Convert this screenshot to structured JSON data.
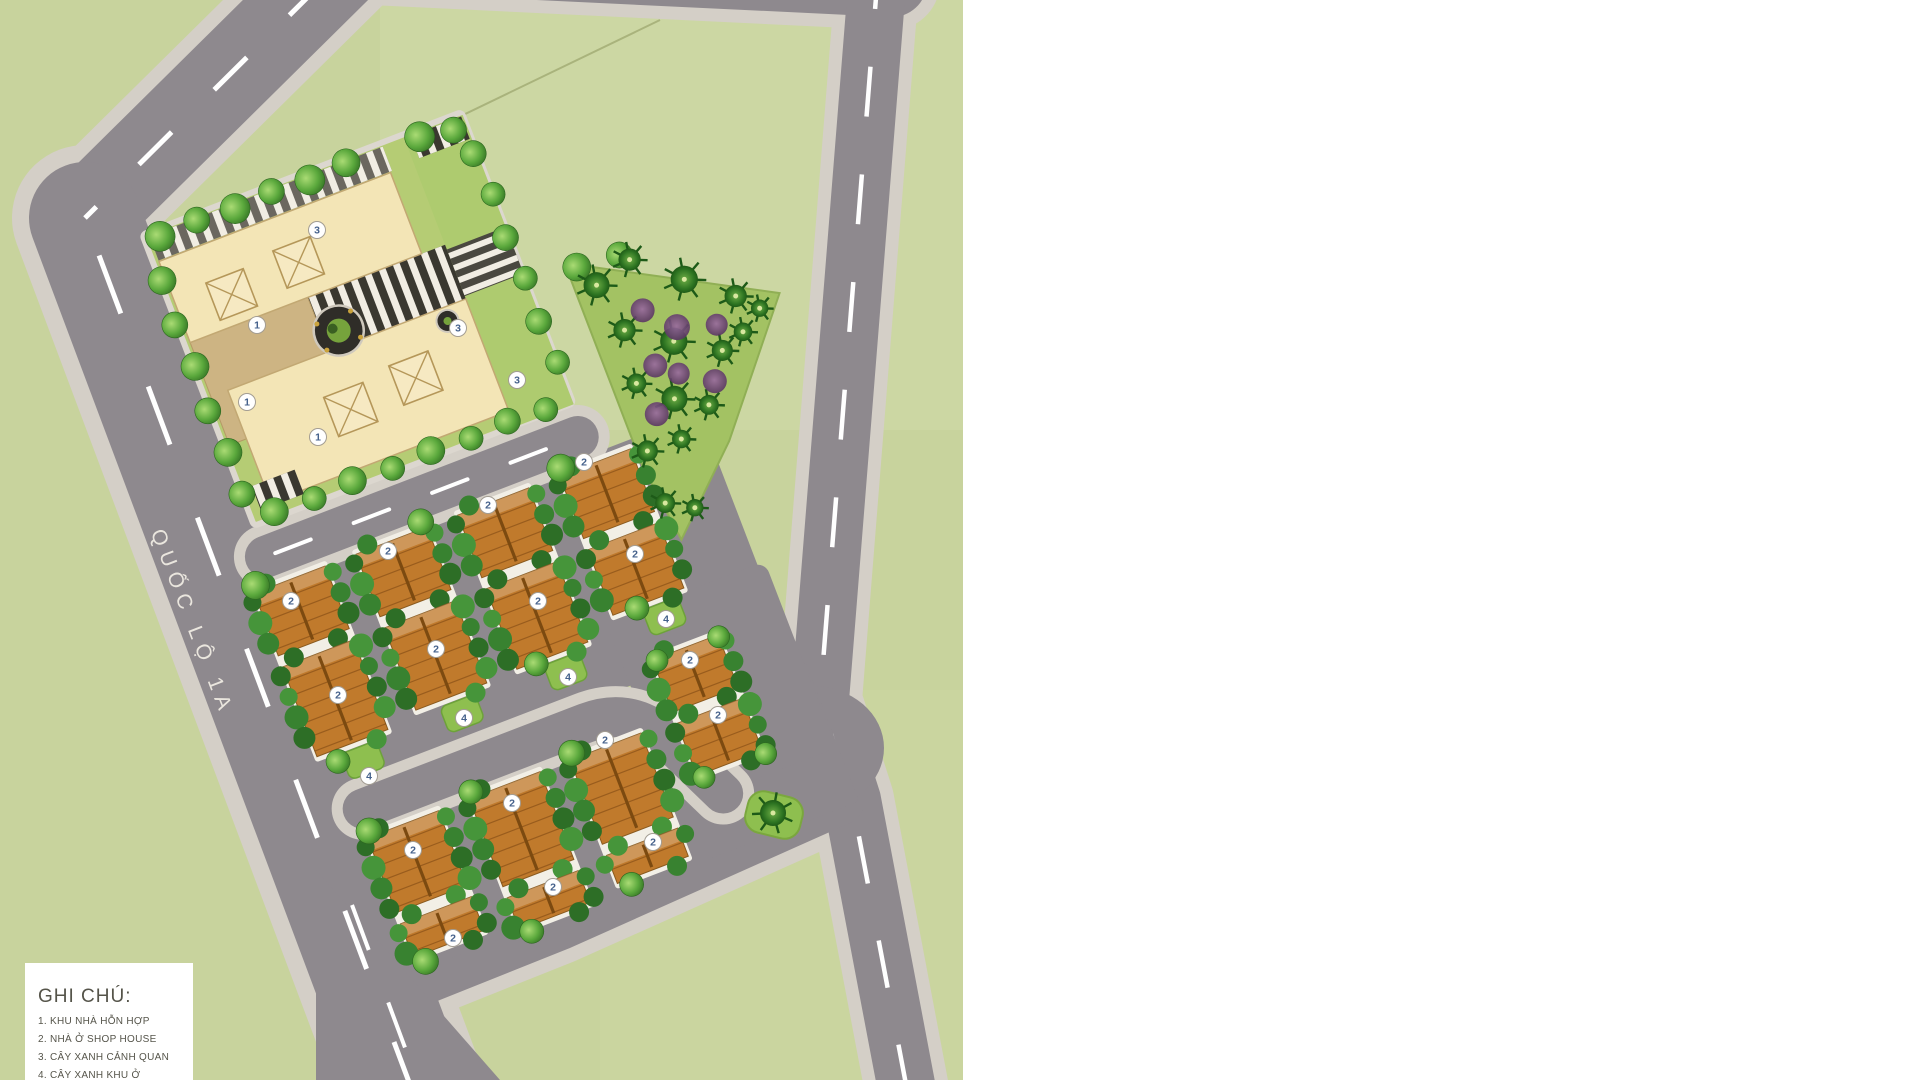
{
  "page": {
    "background": "#ffffff",
    "plan_width": 963,
    "plan_height": 1080
  },
  "road_label": {
    "text": "QUỐC LỘ 1A",
    "x": 186,
    "y": 625,
    "angle": 69
  },
  "legend": {
    "title": "GHI CHÚ:",
    "items": [
      "1. KHU NHÀ HỖN HỢP",
      "2. NHÀ Ở SHOP HOUSE",
      "3. CÂY XANH CẢNH QUAN",
      "4. CÂY XANH KHU Ở"
    ],
    "x": 25,
    "y": 963,
    "width": 168,
    "height": 130
  },
  "colors": {
    "field": "#c8d39d",
    "field_alt": "#cfdaa8",
    "parcel_line": "#a9b37c",
    "asphalt": "#8e898e",
    "sidewalk": "#d4cfc7",
    "dash": "#ffffff",
    "cream": "#f3e5b6",
    "cream_border": "#c2a873",
    "tan": "#cdb483",
    "plaza": "#3a3830",
    "walk_stripe": "#f1ede3",
    "roof": "#c07a2c",
    "roof_ridge": "#7c4a10",
    "roof_line": "#9c621f",
    "row_base": "#f2efe6",
    "bush": [
      "#2d6e26",
      "#46953a",
      "#388230"
    ],
    "park_ground": "#a3c263",
    "strip_green": "#8ebf4f",
    "marker_bg": "#ffffff",
    "marker_ring": "#a39d93",
    "marker_text": "#46628c",
    "label_color": "#eae6de",
    "legend_text": "#55544a"
  },
  "map": {
    "rotation": -21,
    "pivot": [
      420,
      640
    ],
    "markers": [
      {
        "n": "1",
        "x": 257,
        "y": 325
      },
      {
        "n": "1",
        "x": 247,
        "y": 402
      },
      {
        "n": "1",
        "x": 318,
        "y": 437
      },
      {
        "n": "2",
        "x": 291,
        "y": 601
      },
      {
        "n": "2",
        "x": 338,
        "y": 695
      },
      {
        "n": "2",
        "x": 388,
        "y": 551
      },
      {
        "n": "2",
        "x": 436,
        "y": 649
      },
      {
        "n": "2",
        "x": 488,
        "y": 505
      },
      {
        "n": "2",
        "x": 538,
        "y": 601
      },
      {
        "n": "2",
        "x": 584,
        "y": 462
      },
      {
        "n": "2",
        "x": 635,
        "y": 554
      },
      {
        "n": "2",
        "x": 690,
        "y": 660
      },
      {
        "n": "2",
        "x": 718,
        "y": 715
      },
      {
        "n": "2",
        "x": 413,
        "y": 850
      },
      {
        "n": "2",
        "x": 453,
        "y": 938
      },
      {
        "n": "2",
        "x": 512,
        "y": 803
      },
      {
        "n": "2",
        "x": 553,
        "y": 887
      },
      {
        "n": "2",
        "x": 605,
        "y": 740
      },
      {
        "n": "2",
        "x": 653,
        "y": 842
      },
      {
        "n": "3",
        "x": 317,
        "y": 230
      },
      {
        "n": "3",
        "x": 458,
        "y": 328
      },
      {
        "n": "3",
        "x": 517,
        "y": 380
      },
      {
        "n": "4",
        "x": 369,
        "y": 776
      },
      {
        "n": "4",
        "x": 464,
        "y": 718
      },
      {
        "n": "4",
        "x": 568,
        "y": 677
      },
      {
        "n": "4",
        "x": 666,
        "y": 619
      }
    ],
    "rows": [
      {
        "x": 282,
        "w": 76,
        "blocks": [
          [
            537,
            604
          ],
          [
            616,
            712
          ]
        ]
      },
      {
        "x": 391,
        "w": 76,
        "blocks": [
          [
            537,
            604
          ],
          [
            616,
            704
          ]
        ]
      },
      {
        "x": 500,
        "w": 76,
        "blocks": [
          [
            537,
            604
          ],
          [
            616,
            702
          ]
        ]
      },
      {
        "x": 609,
        "w": 76,
        "blocks": [
          [
            537,
            604
          ],
          [
            616,
            686
          ]
        ]
      },
      {
        "x": 630,
        "w": 70,
        "blocks": [
          [
            742,
            798
          ],
          [
            810,
            866
          ]
        ]
      },
      {
        "x": 300,
        "w": 76,
        "blocks": [
          [
            806,
            886
          ],
          [
            898,
            934
          ]
        ]
      },
      {
        "x": 409,
        "w": 76,
        "blocks": [
          [
            806,
            900
          ],
          [
            912,
            946
          ]
        ]
      },
      {
        "x": 517,
        "w": 76,
        "blocks": [
          [
            806,
            896
          ],
          [
            908,
            938
          ]
        ]
      }
    ],
    "green_strips": [
      {
        "x": 305,
        "y": 718,
        "w": 38,
        "h": 28
      },
      {
        "x": 414,
        "y": 710,
        "w": 38,
        "h": 28
      },
      {
        "x": 526,
        "y": 708,
        "w": 38,
        "h": 28
      },
      {
        "x": 638,
        "y": 692,
        "w": 38,
        "h": 28
      }
    ],
    "pyramids": [
      [
        368,
        250,
        40
      ],
      [
        442,
        244,
        40
      ],
      [
        438,
        400,
        42
      ],
      [
        510,
        394,
        42
      ]
    ],
    "trees": [
      [
        322,
        170,
        15
      ],
      [
        362,
        168,
        13
      ],
      [
        402,
        171,
        15
      ],
      [
        442,
        168,
        13
      ],
      [
        482,
        171,
        15
      ],
      [
        522,
        168,
        14
      ],
      [
        600,
        170,
        15
      ],
      [
        634,
        176,
        13
      ],
      [
        308,
        212,
        14
      ],
      [
        304,
        258,
        13
      ],
      [
        308,
        304,
        14
      ],
      [
        304,
        350,
        13
      ],
      [
        308,
        396,
        14
      ],
      [
        306,
        440,
        13
      ],
      [
        330,
        468,
        14
      ],
      [
        372,
        470,
        12
      ],
      [
        414,
        467,
        14
      ],
      [
        456,
        470,
        12
      ],
      [
        498,
        467,
        14
      ],
      [
        540,
        470,
        12
      ],
      [
        580,
        467,
        13
      ],
      [
        620,
        470,
        12
      ],
      [
        644,
        205,
        13
      ],
      [
        648,
        250,
        12
      ],
      [
        644,
        295,
        13
      ],
      [
        648,
        340,
        12
      ],
      [
        645,
        385,
        13
      ],
      [
        648,
        430,
        12
      ],
      [
        700,
        348,
        14
      ],
      [
        744,
        352,
        13
      ],
      [
        286,
        530,
        14
      ],
      [
        463,
        530,
        13
      ],
      [
        613,
        530,
        14
      ],
      [
        300,
        724,
        12
      ],
      [
        520,
        704,
        12
      ],
      [
        634,
        688,
        12
      ],
      [
        304,
        800,
        13
      ],
      [
        413,
        800,
        12
      ],
      [
        521,
        800,
        13
      ],
      [
        310,
        942,
        13
      ],
      [
        420,
        952,
        12
      ],
      [
        530,
        944,
        12
      ],
      [
        634,
        744,
        11
      ],
      [
        700,
        744,
        11
      ],
      [
        636,
        870,
        11
      ],
      [
        702,
        870,
        11
      ]
    ],
    "palms_local": [
      [
        712,
        372,
        21
      ],
      [
        752,
        360,
        18
      ],
      [
        796,
        398,
        22
      ],
      [
        838,
        432,
        18
      ],
      [
        722,
        424,
        18
      ],
      [
        764,
        452,
        22
      ],
      [
        806,
        478,
        17
      ],
      [
        714,
        478,
        16
      ],
      [
        744,
        506,
        21
      ],
      [
        700,
        545,
        17
      ],
      [
        736,
        546,
        15
      ],
      [
        774,
        524,
        16
      ],
      [
        856,
        452,
        14
      ],
      [
        832,
        468,
        15
      ],
      [
        698,
        600,
        16
      ],
      [
        724,
        615,
        14
      ]
    ],
    "palms_screen": [
      [
        773,
        813,
        21
      ]
    ],
    "shrubs": [
      [
        746,
        412,
        12
      ],
      [
        772,
        440,
        13
      ],
      [
        738,
        468,
        12
      ],
      [
        788,
        504,
        12
      ],
      [
        757,
        484,
        11
      ],
      [
        722,
        514,
        12
      ],
      [
        810,
        452,
        11
      ]
    ]
  }
}
